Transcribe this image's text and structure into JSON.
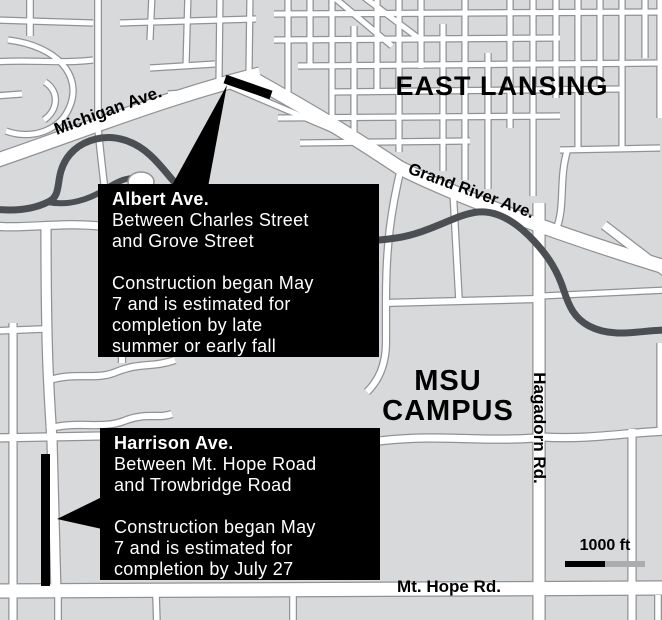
{
  "map": {
    "area_labels": {
      "east_lansing": "EAST LANSING",
      "msu_line1": "MSU",
      "msu_line2": "CAMPUS"
    },
    "road_labels": {
      "michigan": "Michigan Ave.",
      "grand_river": "Grand River Ave.",
      "hagadorn": "Hagadorn Rd.",
      "mt_hope": "Mt. Hope Rd."
    },
    "callouts": [
      {
        "id": "albert",
        "title": "Albert Ave.",
        "location_lines": [
          "Between Charles Street",
          "and Grove Street"
        ],
        "detail_lines": [
          "Construction began May",
          "7 and is estimated for",
          "completion by late",
          "summer or early fall"
        ]
      },
      {
        "id": "harrison",
        "title": "Harrison Ave.",
        "location_lines": [
          "Between Mt. Hope Road",
          "and Trowbridge Road"
        ],
        "detail_lines": [
          "Construction began May",
          "7 and is estimated for",
          "completion by July 27"
        ]
      }
    ],
    "scale": {
      "label": "1000 ft"
    },
    "colors": {
      "background": "#d8d9da",
      "road_fill": "#ffffff",
      "road_casing": "#909295",
      "river": "#4b4f54",
      "construction": "#000000",
      "callout_bg": "#000000",
      "callout_text": "#ffffff",
      "label_text": "#000000",
      "scale_black": "#000000",
      "scale_gray": "#aaacae"
    }
  }
}
